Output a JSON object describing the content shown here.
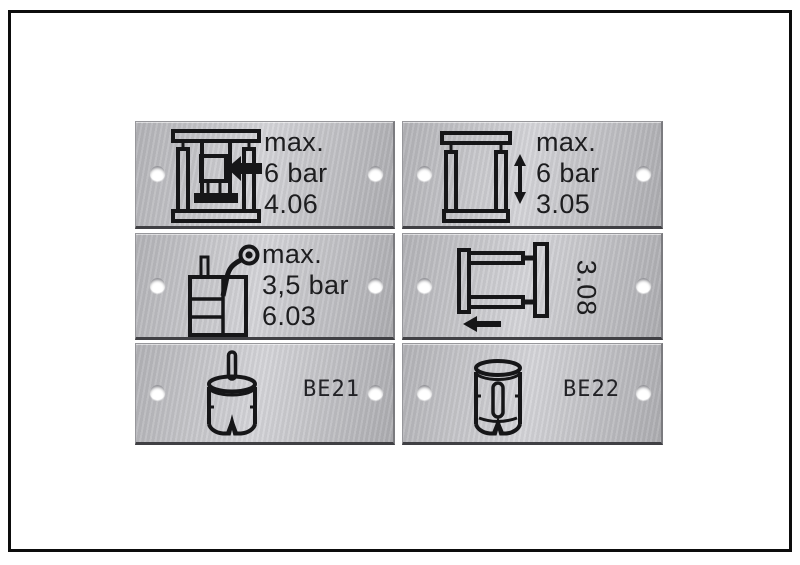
{
  "scene": "photo of six engraved brushed-aluminium machine labels with mounting holes, arranged in two columns and three rows inside a black keyline frame",
  "colors": {
    "background": "#ffffff",
    "frame": "#0d0d0d",
    "metal_light": "#d6d6da",
    "metal_dark": "#aeaeb2",
    "engraving": "#1d1d1f",
    "hole": "#ffffff",
    "plate_bottom_edge": "#404044"
  },
  "plates": [
    {
      "id": "plate-top-left",
      "icon": "stamping-press-icon",
      "lines": [
        "max.",
        "6 bar",
        "4.06"
      ]
    },
    {
      "id": "plate-top-right",
      "icon": "vertical-clamp-stroke-icon",
      "lines": [
        "max.",
        "6 bar",
        "3.05"
      ]
    },
    {
      "id": "plate-middle-left",
      "icon": "tank-with-pressure-gauge-icon",
      "lines": [
        "max.",
        "3,5 bar",
        "6.03"
      ]
    },
    {
      "id": "plate-middle-right",
      "icon": "horizontal-clamp-arrow-icon",
      "rotated_label": "3.08"
    },
    {
      "id": "plate-bottom-left",
      "icon": "bell-cylinder-rod-icon",
      "label": "BE21"
    },
    {
      "id": "plate-bottom-right",
      "icon": "cup-cylinder-pin-icon",
      "label": "BE22"
    }
  ]
}
